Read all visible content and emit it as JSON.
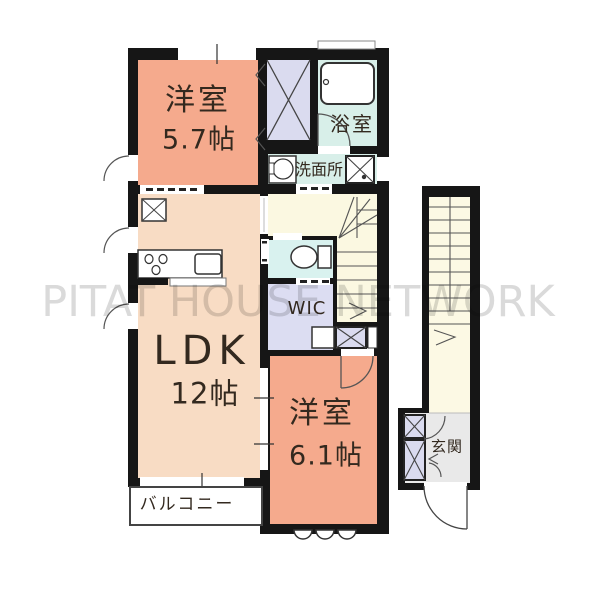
{
  "watermark": "PITAT HOUSE NETWORK",
  "plan": {
    "bedroom_top": {
      "name": "洋室",
      "size": "5.7帖"
    },
    "bathroom": {
      "name": "浴室"
    },
    "washroom": {
      "name": "洗面所"
    },
    "wic": {
      "name": "WIC"
    },
    "ldk": {
      "name": "LDK",
      "size": "12帖"
    },
    "bedroom_bottom": {
      "name": "洋室",
      "size": "6.1帖"
    },
    "balcony": {
      "name": "バルコニー"
    },
    "entrance": {
      "name": "玄関"
    }
  },
  "icons": {
    "bathtub": "bathtub-icon",
    "toilet": "toilet-icon",
    "washbasin": "washbasin-icon",
    "washer_pan": "washer-pan-x-icon",
    "stove": "stove-burners-icon",
    "kitchen_sink": "kitchen-sink-icon",
    "refrigerator": "refrigerator-x-icon",
    "closet_cross": "closet-x-icon",
    "stairs": "stairs-icon",
    "door_arc": "door-swing-arc-icon",
    "window": "window-icon"
  },
  "colors": {
    "wall": "#161616",
    "bedroom": "#f5aa8d",
    "ldk": "#f8dcc4",
    "closet": "#dadbef",
    "wet_area": "#d8efe9",
    "toilet_room": "#d9f2ef",
    "stair_hall": "#fbf8e1",
    "outer_stairs": "#fcf9e4",
    "entrance_floor": "#e9e9e9",
    "watermark": "#c3c3c3"
  }
}
